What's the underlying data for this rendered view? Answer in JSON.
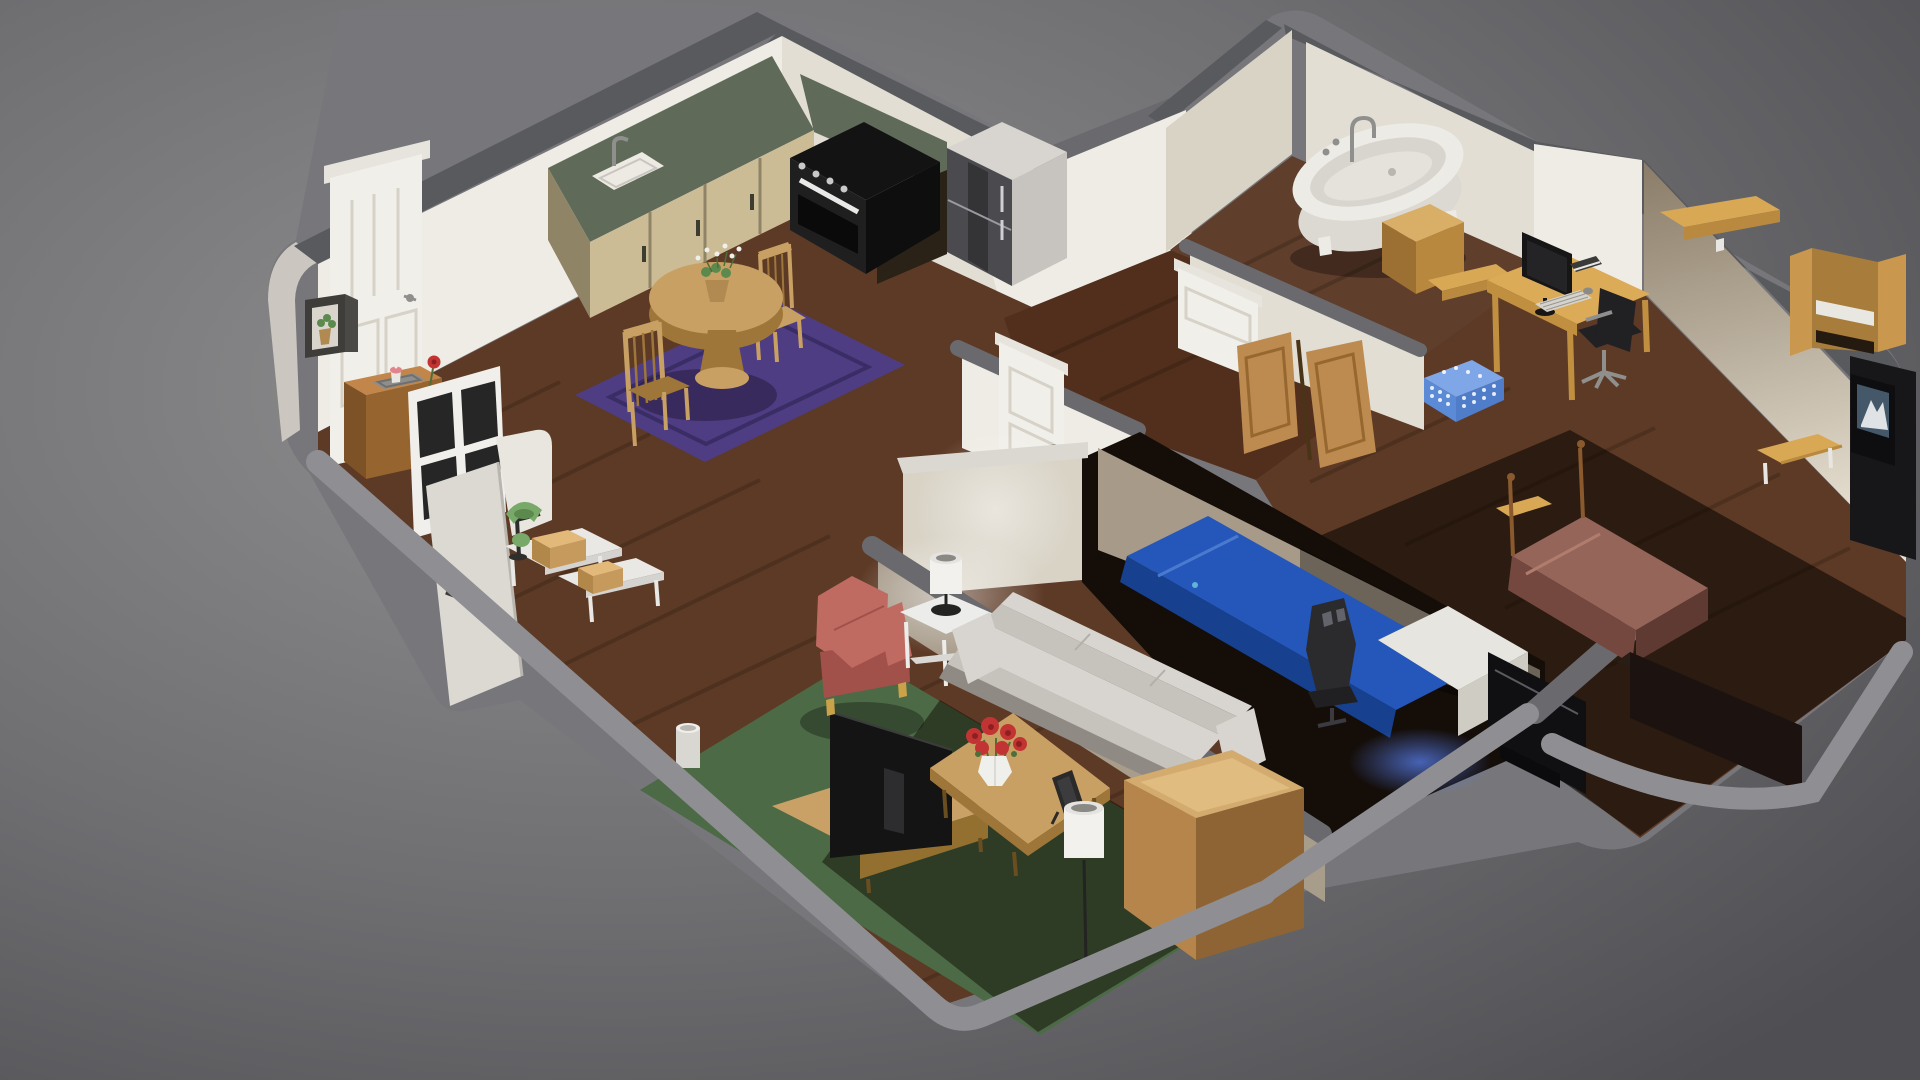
{
  "meta": {
    "description": "Isometric cutaway 3D render of a furnished apartment, dollhouse view on gray backdrop",
    "style": "low-poly 3D render, walls cut away, soft lighting"
  },
  "palette": {
    "bgCenter": "#909091",
    "bgMid": "#6f6f72",
    "bgEdge": "#4f4f53",
    "shellBase": "#77777b",
    "capDark": "#595a5d",
    "capMid": "#6a6a6e",
    "rimLight": "#8f8f93",
    "rimDark": "#2c1a10",
    "outerLit": "#cbc7c0",
    "wallLit": "#efece5",
    "wallLit2": "#e3ded4",
    "wallSpeckle": "#d9d3c6",
    "wallShade": "#a89c8b",
    "whiteCap": "#dbd8d2",
    "wallShadeDark": "rgba(0,0,0,0.35)",
    "floorWood": "#5d3a26",
    "floorHall": "#512f1c",
    "floorBath": "#5f3e2b",
    "floorDark": "#140d08",
    "bedroomWall": "#a79a88",
    "plankLine": "rgba(0,0,0,0.16)",
    "shadow30": "rgba(0,0,0,0.30)",
    "shadow45": "rgba(10,4,0,0.45)",
    "shadow60": "rgba(12,6,2,0.60)",
    "shadowRug": "rgba(20,8,30,0.35)",
    "rugPurple": "#4e3d82",
    "rugPurpleLine": "#3a2d66",
    "rugGreen": "#4c6a45",
    "counterTop": "#5f6b58",
    "cabinetFace": "#cbbc96",
    "cabinetSide": "#8f8466",
    "cabinetDark": "#2a2216",
    "handleDark": "#3c3c30",
    "sinkWhite": "#eceae3",
    "sinkInner": "#c9c6c0",
    "metalGray": "#8f8f8d",
    "stoveTop": "#131313",
    "stoveFace": "#1f1f1f",
    "stoveSide": "#0e0e0e",
    "ovenGlass": "#0a0a0a",
    "ovenHandle": "#e9e9e7",
    "knobGray": "#c9c9c7",
    "fridgeTop": "#d8d5d0",
    "fridgeFront": "#4b4b4f",
    "fridgeSide": "#c7c4bf",
    "fridgeLine": "#9a9aa0",
    "fridgeHandle": "#cfcfd4",
    "doorWhite": "#f1efe9",
    "doorLintel": "#e7e4dd",
    "doorShade": "#d6d2c8",
    "doorGray": "#dcd9d2",
    "doorGrayEdge": "#b9b6af",
    "windowFrame": "#f0efeb",
    "windowPane": "#262626",
    "cubeDark": "#3e3d3a",
    "cubeSide": "#4a4946",
    "cubeInner": "#d9d5cd",
    "potTan": "#b08a50",
    "entryTop": "#c2854a",
    "entryFront": "#96642f",
    "entrySide": "#7c5226",
    "trayGray": "#8e8e8c",
    "trayLine": "#6f6f6d",
    "cupcakePink": "#e2848e",
    "cupWhite": "#e9e7e2",
    "vaseWhite": "#efefec",
    "roseRed": "#c23434",
    "roseDark": "#8f1f1f",
    "stemGreen": "#4e6e3a",
    "whiteDesk": "#e9e8e5",
    "whiteDeskEdge": "#d4d3cf",
    "boxTan": "#e3b979",
    "boxFront": "#c59a5c",
    "boxSide": "#b2884a",
    "lampGreen": "#79a969",
    "lampGreenDark": "#5c8a4e",
    "lampArm": "#2e2e2c",
    "chairSalmon": "#c06b62",
    "chairSalmonDark": "#a1514a",
    "footGold": "#c9a24a",
    "tableWhite": "#ececea",
    "shelfWhite": "#d9d8d4",
    "shadeWhite": "#f2f1ed",
    "shadeTop": "#e4e3df",
    "shadeInner": "#8a8984",
    "lampBase": "#232322",
    "sofaLight": "#d8d5d0",
    "sofaMid": "#c6c2bc",
    "sofaDark": "#aaa59e",
    "sofaBase": "#8f8a84",
    "sofaSeam": "#b3afa9",
    "cofTop": "#c9a063",
    "cofSide": "#9f7639",
    "legDark": "#6b4e1f",
    "frameDark": "#2a2a2a",
    "frameInner": "#3c3c3e",
    "tvBlack": "#141414",
    "tvInset": "#2d2d2f",
    "tvPole": "#8f8f8f",
    "tvPlate": "#9a9a98",
    "tvEdge": "#3c3c3e",
    "benchTan": "#c9a166",
    "benchFront": "#93702f",
    "cabTop": "#d3ab6e",
    "cabTopLight": "#e0bc80",
    "cabFront": "#b5854c",
    "cabSide": "#8f6434",
    "binWhite": "#d9d7d2",
    "binTop": "#efeeea",
    "binInner": "#b9b7b2",
    "bedBlue": "#2457b9",
    "bedBlueDark": "#17408f",
    "bedFold": "#4a7ad0",
    "bedWrinkle": "#5fb4d8",
    "pillowWhite": "#e7e5df",
    "pillowShade": "#cfccc4",
    "gamingDark": "#2b2b2e",
    "gamingLight": "#63636c",
    "gamingSeat": "#202023",
    "gamingBase": "#3a3a40",
    "panelDark": "#101013",
    "panelLine": "#5a5a60",
    "panelBase": "#0b0b0d",
    "tubWhite": "#edebe6",
    "tubBody": "#dcd9d2",
    "tubInner": "#d8d5ce",
    "tubBottom": "#e4e2db",
    "drainGray": "#b9b6b0",
    "bathTan": "#d9ae66",
    "bathTanFront": "#b9883f",
    "bathTanSide": "#9c6f33",
    "bifoldTan": "#bd8b50",
    "bifoldLine": "#96672f",
    "bifoldGap": "#4a3418",
    "basketBlue": "#5b8ad6",
    "basketBlueDark": "#4f7dc9",
    "basketRim": "#7fa6e6",
    "holeWhite": "rgba(255,255,255,0.85)",
    "deskTan": "#dcab58",
    "deskEdge": "#c09040",
    "monDark": "#161616",
    "monScreen": "#242426",
    "keyLight": "#d6d3cd",
    "keyLine": "#9a978f",
    "mouseGray": "#8a8a88",
    "bookDark": "#3a3a38",
    "chairBlack": "#212124",
    "chairGray": "#8f8f8d",
    "shelfTan": "#d9a855",
    "shelfFront": "#b8893f",
    "bracketWhite": "#e8e6e2",
    "caseTan": "#c9984e",
    "caseBack": "#a87c3a",
    "caseShelfDark": "#241a10",
    "cushionWhite": "#e9e7e2",
    "wardrobeDark": "#17171a",
    "picFrame": "#0e0e10",
    "picSky": "#44586a",
    "picSnow": "#dfe3e5",
    "mauve": "#96655a",
    "mauveDark": "#74483f",
    "mauveDark2": "#5f3a33",
    "mauveFold": "#b07c6e",
    "postWood": "#8a5a2e",
    "dresserDark": "#1c1310",
    "dresserTop": "#2a1d16",
    "officeWallDark": "#8a7c68",
    "officeWallLight": "#e8e1d2",
    "glowWhite": "#ffffff",
    "glowBlue": "#5478e0",
    "stubWhite": "#e9e6df"
  },
  "scene": {
    "type": "apartment-cutaway",
    "rooms": [
      {
        "name": "kitchen-dining",
        "objects": [
          "l-shaped counter with green top",
          "kitchen sink",
          "stove with oven",
          "refrigerator",
          "round dining table",
          "two wooden chairs",
          "potted orchid centerpiece",
          "purple area rug",
          "white front door",
          "wall cube shelf with plant",
          "entry side table with tray and rose vase",
          "white window frame",
          "open entry door",
          "white entry desk",
          "green banker lamp",
          "tan storage boxes"
        ]
      },
      {
        "name": "living-room",
        "objects": [
          "salmon wingback armchair",
          "white side table",
          "table lamp",
          "white three-seat sofa",
          "coffee table",
          "red rose bouquet in vase",
          "standing picture frame",
          "flat-screen tv",
          "tv bench",
          "white floor lamp",
          "green area rug",
          "tan sideboard cabinet",
          "white waste bin"
        ]
      },
      {
        "name": "hallway",
        "objects": [
          "white interior door",
          "bifold closet doors"
        ]
      },
      {
        "name": "bathroom",
        "objects": [
          "white clawfoot bathtub",
          "bath faucet",
          "tan side table"
        ]
      },
      {
        "name": "middle-bedroom",
        "objects": [
          "bed with blue blanket",
          "white pillow",
          "black gaming chair",
          "dark tv panel",
          "white interior door"
        ]
      },
      {
        "name": "office-bedroom",
        "objects": [
          "wooden desk",
          "monitor",
          "keyboard",
          "mouse",
          "book",
          "black office chair",
          "two wall shelves",
          "blue laundry basket",
          "tan bookcase with cushion",
          "wooden bench",
          "framed mountain picture",
          "dark wardrobe",
          "bed with mauve blanket",
          "bed posts",
          "dark dresser"
        ]
      }
    ]
  }
}
